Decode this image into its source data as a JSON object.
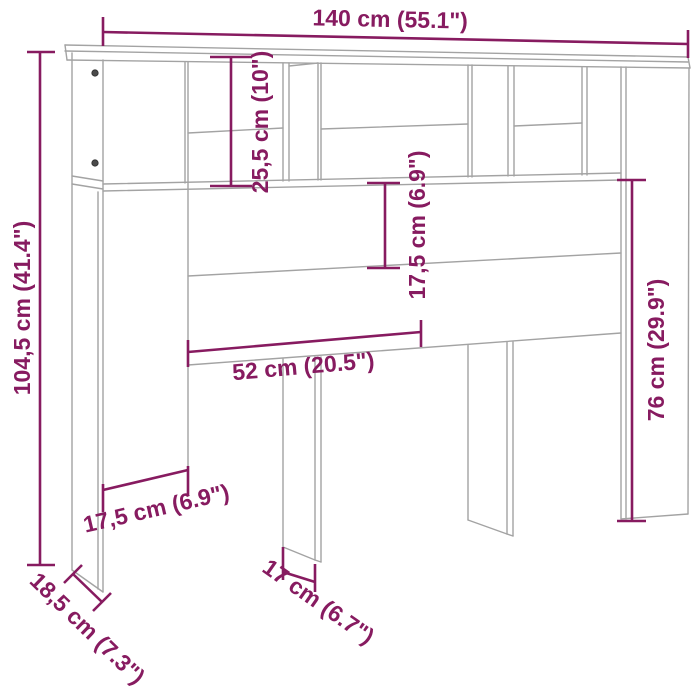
{
  "dimensions": {
    "total_width": "140 cm (55.1\")",
    "total_height": "104,5 cm (41.4\")",
    "top_shelf_height": "25,5 cm (10\")",
    "panel_height": "17,5 cm (6.9\")",
    "opening_width": "52 cm (20.5\")",
    "right_section_height": "76 cm (29.9\")",
    "side_opening_width": "17,5 cm (6.9\")",
    "left_leg_depth": "18,5 cm (7.3\")",
    "center_leg_depth": "17 cm (6.7\")"
  },
  "colors": {
    "dimension_accent": "#871b60",
    "furniture_line": "#a3a3a3",
    "background": "#ffffff"
  }
}
